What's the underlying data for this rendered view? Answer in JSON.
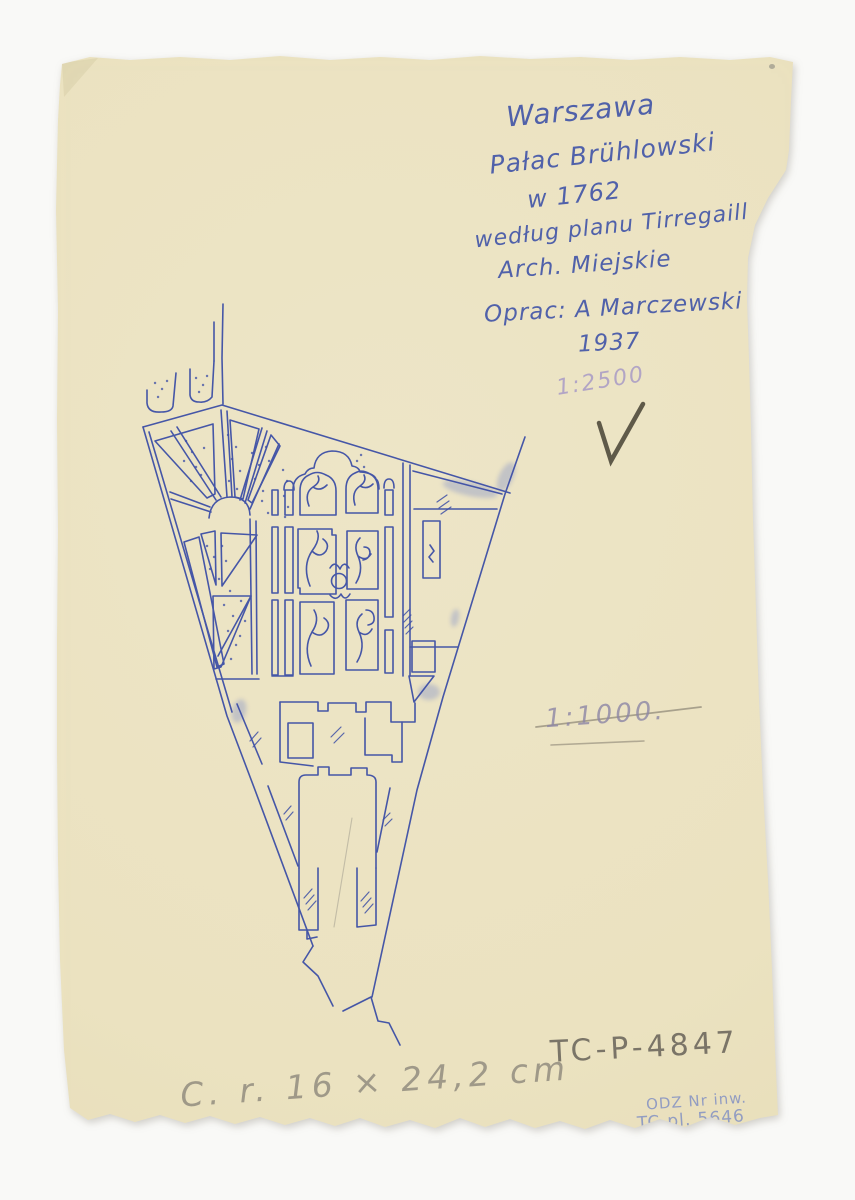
{
  "page": {
    "background_color": "#f9f9f7",
    "paper_color": "#ece4c5",
    "ink_color": "#3d4fa6",
    "pencil_color": "#6b665c"
  },
  "annotations": {
    "title_block": {
      "lines": [
        "Warszawa",
        "Pałac Brühlowski",
        "w 1762",
        "według planu Tirregaill",
        "Arch. Miejskie",
        "Oprac: A Marczewski",
        "1937"
      ]
    },
    "scale_crossed_out": "1:2500",
    "scale_struck": "1:1000.",
    "catalog_number": "TC-P-4847",
    "size_note": "C. r. 16 × 24,2 cm",
    "inventory_stamp": {
      "line1": "ODZ Nr inw.",
      "line2": "TC-pl. 5646"
    }
  }
}
